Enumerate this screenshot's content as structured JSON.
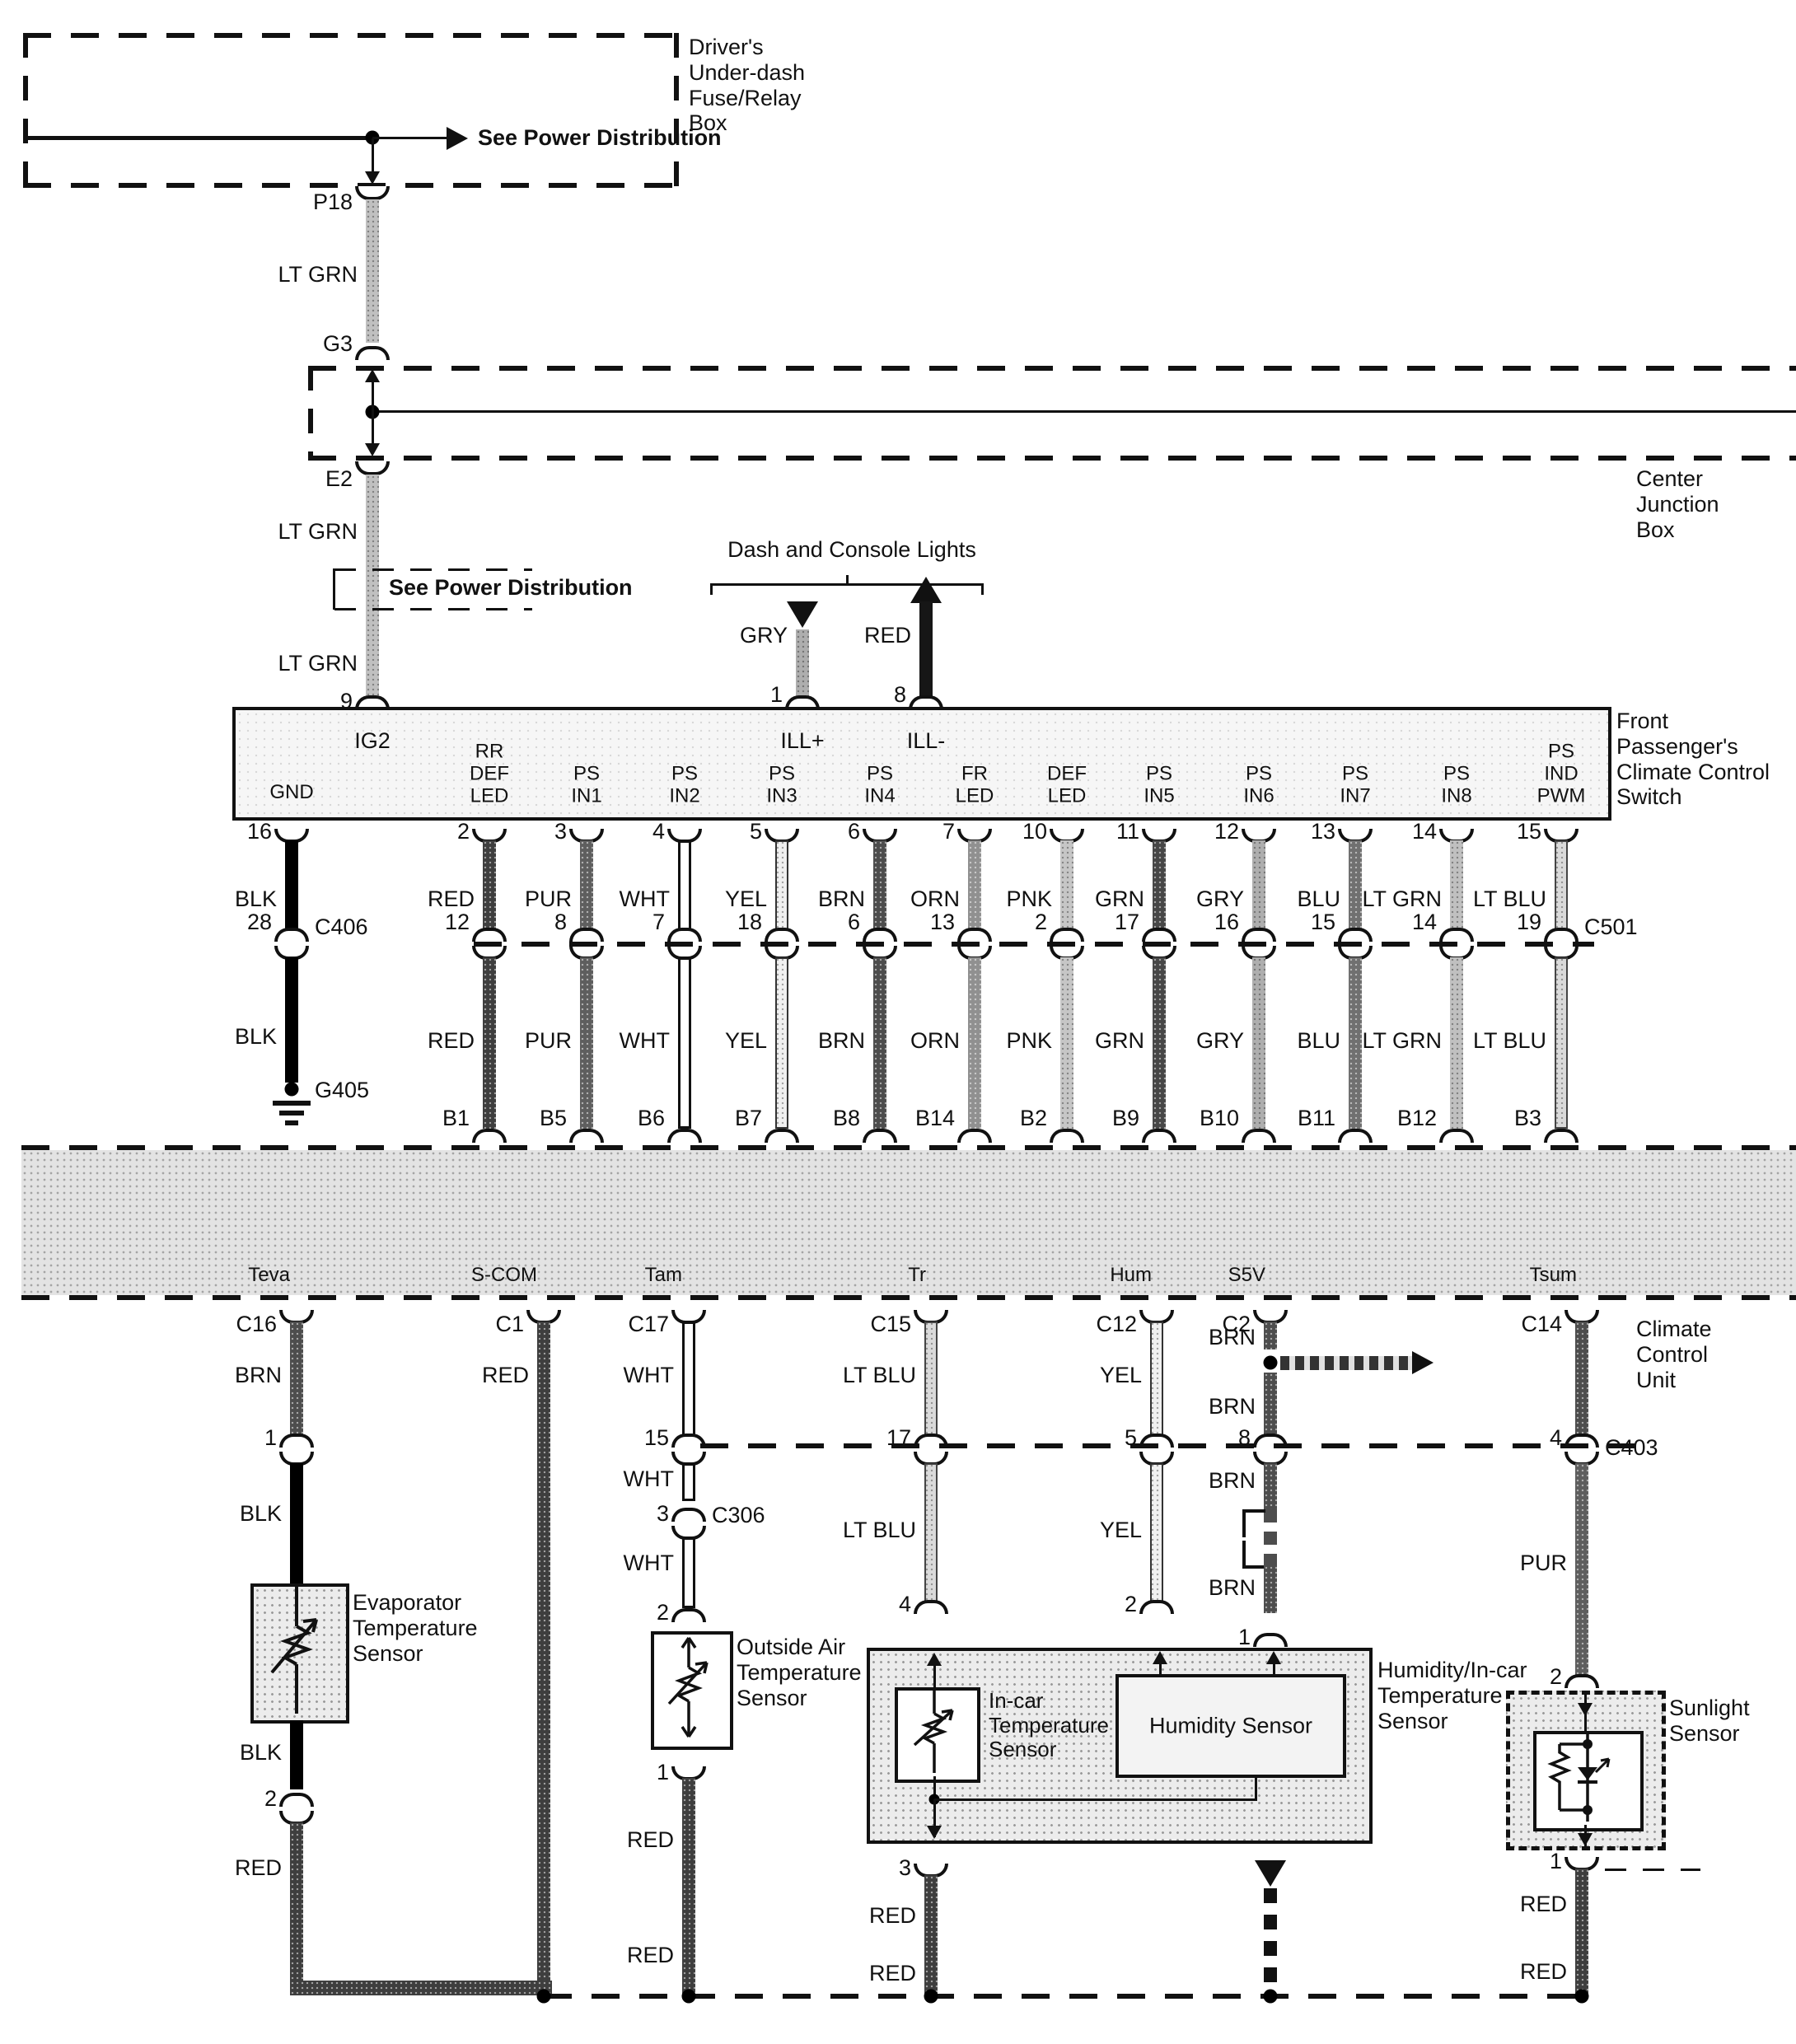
{
  "palette": {
    "ink": "#111111",
    "paper": "#ffffff",
    "band_gray": "#e3e3e3"
  },
  "fuse_box": {
    "label": "Driver's\nUnder-dash\nFuse/Relay\nBox",
    "see_power": "See Power Distribution",
    "pin_out": "P18"
  },
  "feed": {
    "color1": "LT GRN",
    "g3": "G3",
    "e2": "E2",
    "color2": "LT GRN",
    "see_power": "See Power Distribution",
    "color3": "LT GRN",
    "pin_in": "9",
    "ig2": "IG2"
  },
  "junction_box": {
    "label": "Center\nJunction\nBox"
  },
  "dash_lights": {
    "title": "Dash and Console Lights",
    "gry": {
      "color": "GRY",
      "pin": "1",
      "signal": "ILL+"
    },
    "red": {
      "color": "RED",
      "pin": "8",
      "signal": "ILL-"
    }
  },
  "switch_box": {
    "label": "Front\nPassenger's\nClimate Control\nSwitch",
    "gnd": "GND"
  },
  "gnd_col": {
    "pin": "16",
    "color1": "BLK",
    "mid": "28",
    "connector": "C406",
    "color2": "BLK",
    "ground": "G405"
  },
  "columns": [
    {
      "name": "RR\nDEF\nLED",
      "pin": "2",
      "color": "RED",
      "mid": "12",
      "color2": "RED",
      "bpin": "B1"
    },
    {
      "name": "PS\nIN1",
      "pin": "3",
      "color": "PUR",
      "mid": "8",
      "color2": "PUR",
      "bpin": "B5"
    },
    {
      "name": "PS\nIN2",
      "pin": "4",
      "color": "WHT",
      "mid": "7",
      "color2": "WHT",
      "bpin": "B6"
    },
    {
      "name": "PS\nIN3",
      "pin": "5",
      "color": "YEL",
      "mid": "18",
      "color2": "YEL",
      "bpin": "B7"
    },
    {
      "name": "PS\nIN4",
      "pin": "6",
      "color": "BRN",
      "mid": "6",
      "color2": "BRN",
      "bpin": "B8"
    },
    {
      "name": "FR\nLED",
      "pin": "7",
      "color": "ORN",
      "mid": "13",
      "color2": "ORN",
      "bpin": "B14"
    },
    {
      "name": "DEF\nLED",
      "pin": "10",
      "color": "PNK",
      "mid": "2",
      "color2": "PNK",
      "bpin": "B2"
    },
    {
      "name": "PS\nIN5",
      "pin": "11",
      "color": "GRN",
      "mid": "17",
      "color2": "GRN",
      "bpin": "B9"
    },
    {
      "name": "PS\nIN6",
      "pin": "12",
      "color": "GRY",
      "mid": "16",
      "color2": "GRY",
      "bpin": "B10"
    },
    {
      "name": "PS\nIN7",
      "pin": "13",
      "color": "BLU",
      "mid": "15",
      "color2": "BLU",
      "bpin": "B11"
    },
    {
      "name": "PS\nIN8",
      "pin": "14",
      "color": "LT GRN",
      "mid": "14",
      "color2": "LT GRN",
      "bpin": "B12"
    },
    {
      "name": "PS IND\nPWM",
      "pin": "15",
      "color": "LT BLU",
      "mid": "19",
      "color2": "LT BLU",
      "bpin": "B3",
      "connector": "C501"
    }
  ],
  "ccu": {
    "label": "Climate\nControl\nUnit",
    "signals": [
      "Teva",
      "S-COM",
      "Tam",
      "Tr",
      "Hum",
      "S5V",
      "Tsum"
    ]
  },
  "lower": {
    "teva": {
      "connector": "C16",
      "color1": "BRN",
      "pin1": "1",
      "color2": "BLK",
      "sensor": "Evaporator\nTemperature\nSensor",
      "color3": "BLK",
      "pin2": "2",
      "color4": "RED"
    },
    "scom": {
      "connector": "C1",
      "color": "RED"
    },
    "tam": {
      "connector": "C17",
      "color1": "WHT",
      "pin15": "15",
      "color2": "WHT",
      "pin3": "3",
      "connector2": "C306",
      "color3": "WHT",
      "pin2": "2",
      "sensor": "Outside Air\nTemperature\nSensor",
      "pin1": "1",
      "red1": "RED",
      "red2": "RED"
    },
    "tr": {
      "connector": "C15",
      "color1": "LT BLU",
      "pin17": "17",
      "color2": "LT BLU",
      "pin4": "4",
      "pin3": "3",
      "red1": "RED",
      "red2": "RED"
    },
    "hum": {
      "connector": "C12",
      "color1": "YEL",
      "pin5": "5",
      "color2": "YEL",
      "pin2": "2"
    },
    "s5v": {
      "connector": "C2",
      "color1": "BRN",
      "color2": "BRN",
      "pin8": "8",
      "color3": "BRN",
      "color4": "BRN",
      "pin1": "1"
    },
    "tsum": {
      "connector": "C14",
      "pin4": "4",
      "connector2": "C403",
      "color": "PUR",
      "pin2": "2",
      "sensor": "Sunlight\nSensor",
      "pin1": "1",
      "red1": "RED",
      "red2": "RED"
    },
    "humbox": {
      "label": "Humidity/In-car\nTemperature\nSensor",
      "incar": "In-car\nTemperature\nSensor",
      "humidity": "Humidity Sensor"
    }
  }
}
